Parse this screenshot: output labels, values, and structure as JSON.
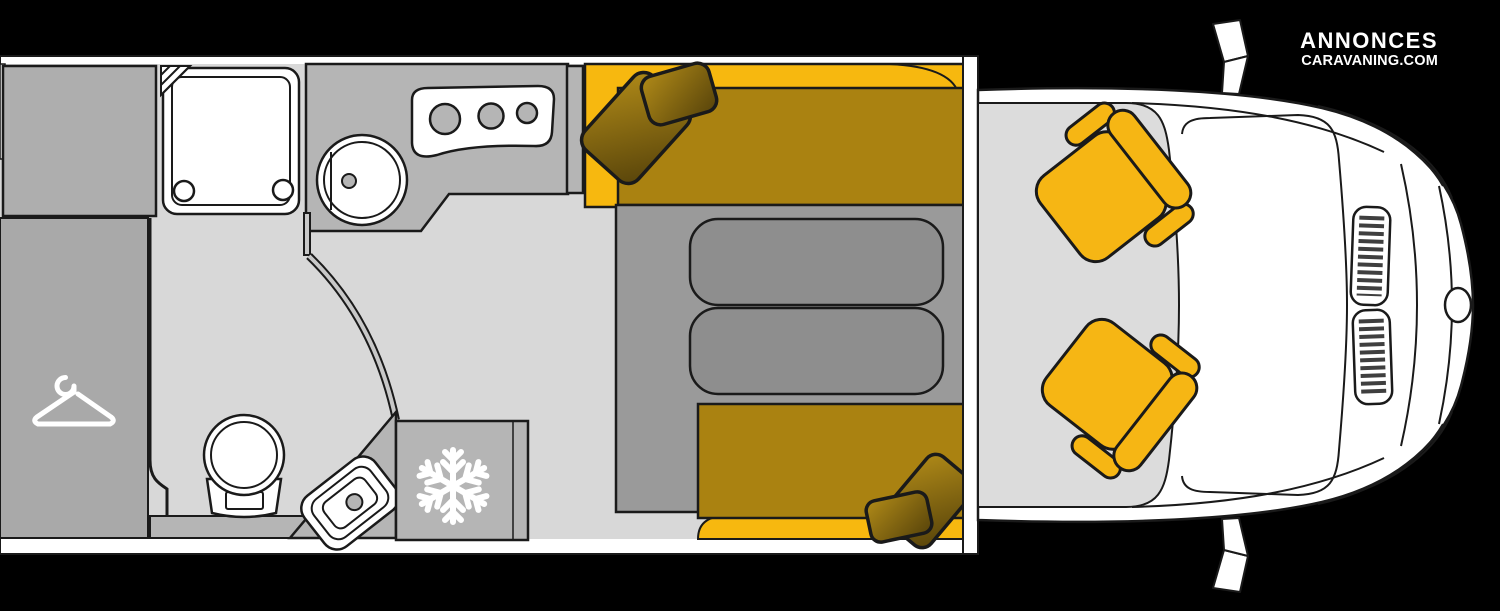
{
  "branding": {
    "line1": "ANNONCES",
    "line2": "CARAVANING.COM"
  },
  "colors": {
    "background": "#000000",
    "floor": "#d8d8d8",
    "bath_floor": "#d8d8d8",
    "cab_floor": "#dcdcdc",
    "furniture_gray": "#b5b5b5",
    "cabinet_gray": "#aeaeae",
    "wardrobe_gray": "#a9a9a9",
    "platform_gray": "#9a9a9a",
    "table_gray": "#8e8e8e",
    "cushion_yellow": "#f7b80f",
    "bed_gold": "#aa8211",
    "seat_yellow": "#f6b614",
    "pillow_gold_light": "#b08a18",
    "pillow_gold_dark": "#57430a",
    "outline": "#1a1a1a",
    "wall_white": "#ffffff"
  },
  "floorplan": {
    "view": "top-down motorhome layout",
    "features": [
      {
        "name": "overhead-cabinet"
      },
      {
        "name": "wardrobe",
        "icon": "hanger-icon"
      },
      {
        "name": "shower-tray",
        "drains": 2
      },
      {
        "name": "toilet"
      },
      {
        "name": "washbasin"
      },
      {
        "name": "bathroom-sliding-door",
        "shape": "curved"
      },
      {
        "name": "kitchen-worktop"
      },
      {
        "name": "kitchen-sink"
      },
      {
        "name": "hob",
        "burners": 3
      },
      {
        "name": "refrigerator",
        "icon": "snowflake-icon"
      },
      {
        "name": "rear-sofa-top",
        "pillows": 2
      },
      {
        "name": "rear-sofa-bottom",
        "pillows": 2
      },
      {
        "name": "dinette-table",
        "segments": 2
      },
      {
        "name": "dinette-platform"
      },
      {
        "name": "driver-swivel-seat"
      },
      {
        "name": "passenger-swivel-seat"
      },
      {
        "name": "cab-floor"
      },
      {
        "name": "vehicle-front-body"
      },
      {
        "name": "radiator-grille",
        "vents": 2
      },
      {
        "name": "fuel-cap"
      },
      {
        "name": "side-mirrors",
        "count": 2
      }
    ]
  }
}
